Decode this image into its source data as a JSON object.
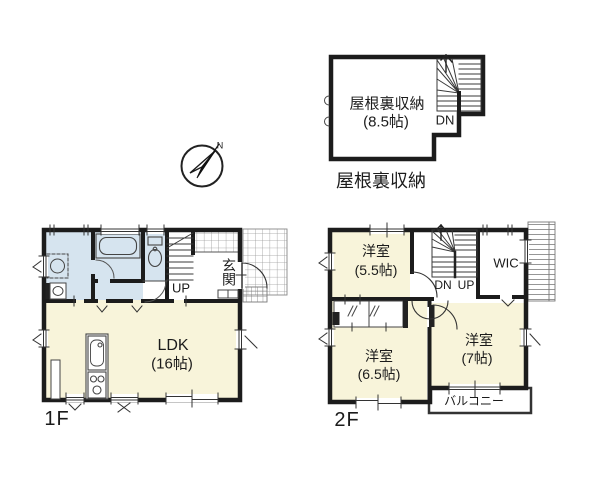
{
  "compass": {
    "north_label": "N"
  },
  "attic": {
    "room_label": "屋根裏収納",
    "room_size": "(8.5帖)",
    "stair_label": "DN",
    "caption": "屋根裏収納"
  },
  "first_floor": {
    "floor_label": "1F",
    "stair_label": "UP",
    "entrance_label": "玄関",
    "ldk_label": "LDK",
    "ldk_size": "(16帖)"
  },
  "second_floor": {
    "floor_label": "2F",
    "stair_label_dn": "DN",
    "stair_label_up": "UP",
    "wic_label": "WIC",
    "balcony_label": "バルコニー",
    "room_55_label": "洋室",
    "room_55_size": "(5.5帖)",
    "room_65_label": "洋室",
    "room_65_size": "(6.5帖)",
    "room_7_label": "洋室",
    "room_7_size": "(7帖)"
  },
  "colors": {
    "wall": "#1c1c1c",
    "room_cream": "#f8f4da",
    "room_blue": "#d6e4ef",
    "tile_line": "#999999",
    "background": "#ffffff"
  }
}
